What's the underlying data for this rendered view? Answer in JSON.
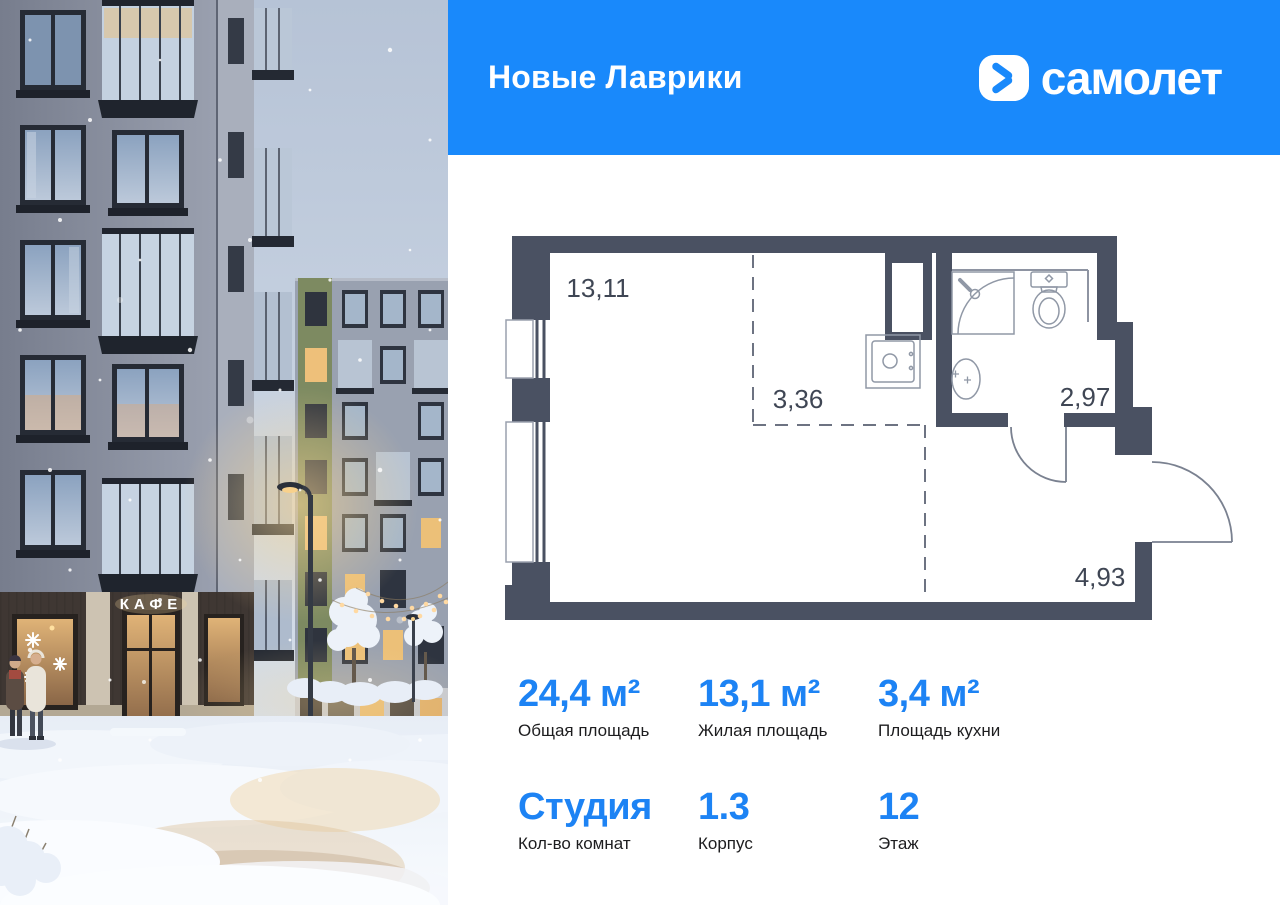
{
  "header": {
    "project_name": "Новые Лаврики",
    "brand_name": "самолет",
    "background_color": "#1989fb"
  },
  "photo": {
    "cafe_sign": "КАФЕ"
  },
  "floorplan": {
    "wall_color": "#4a5162",
    "areas": {
      "living_room": "13,11",
      "hall": "3,36",
      "bathroom": "2,97",
      "entry": "4,93"
    }
  },
  "stats": {
    "accent_color": "#1d83f4",
    "items": [
      {
        "value": "24,4 м²",
        "label": "Общая площадь"
      },
      {
        "value": "13,1 м²",
        "label": "Жилая площадь"
      },
      {
        "value": "3,4 м²",
        "label": "Площадь кухни"
      },
      {
        "value": "Студия",
        "label": "Кол-во комнат"
      },
      {
        "value": "1.3",
        "label": "Корпус"
      },
      {
        "value": "12",
        "label": "Этаж"
      }
    ]
  }
}
